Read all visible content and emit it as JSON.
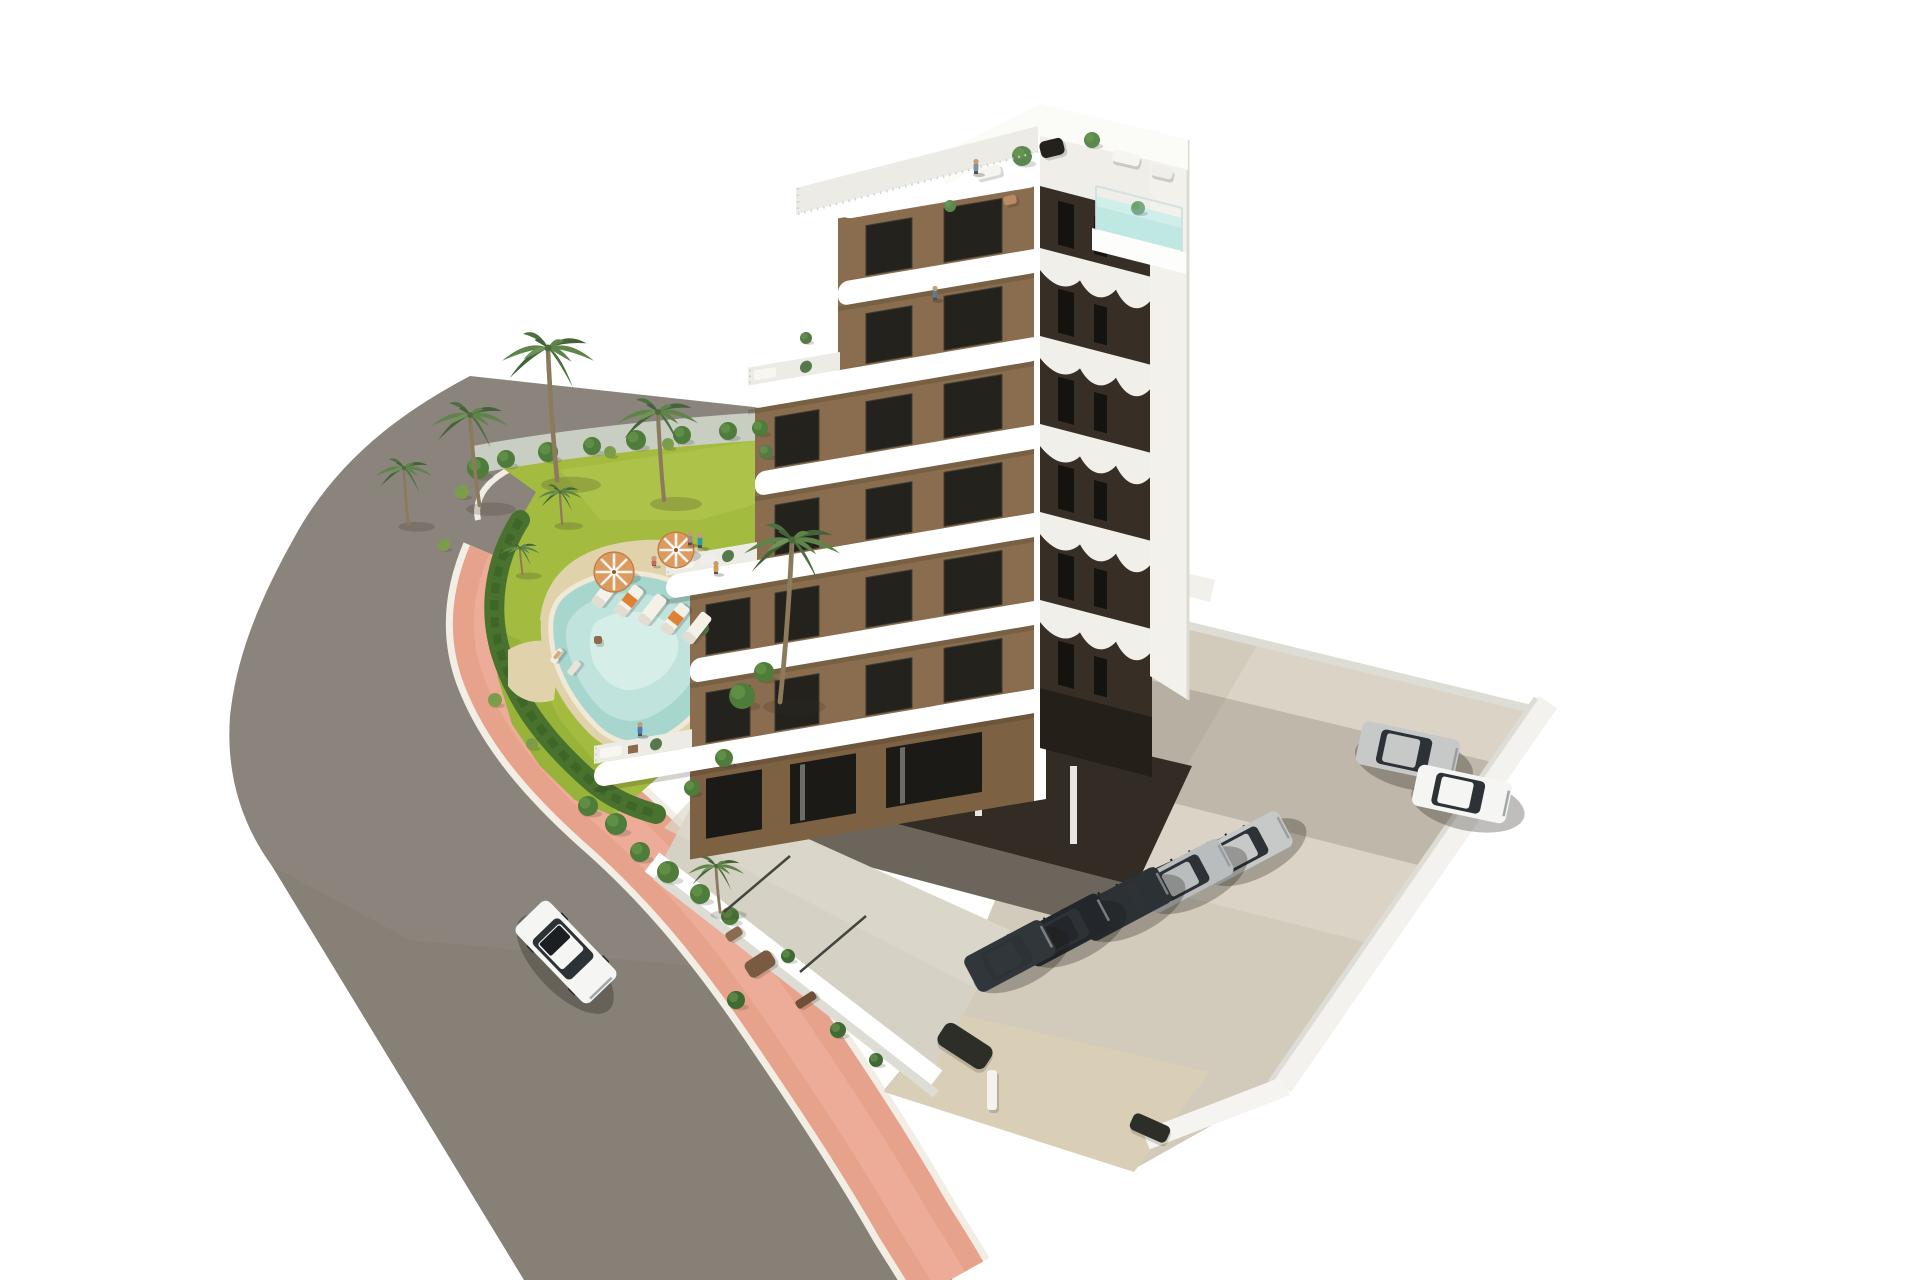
{
  "meta": {
    "type": "3d-architectural-render",
    "view": "aerial-isometric",
    "canvas": [
      1920,
      1280
    ]
  },
  "palette": {
    "road": "#8a847c",
    "road_dk": "#7d776f",
    "sidewalk": "#e7a28c",
    "sidewalk_hi": "#f0b5a0",
    "curb": "#f2eee5",
    "lawn": "#a3bc40",
    "lawn_hi": "#b5c851",
    "lawn_dk": "#8aa930",
    "gravel": "#c9cec3",
    "hedge": "#48722e",
    "hedge_dk": "#3a6126",
    "deck": "#e0d2ab",
    "coping": "#efe9d6",
    "water": "#a7d6cf",
    "water_hi": "#c4e6df",
    "water_pale": "#d9f0ea",
    "white": "#ffffff",
    "white_dim": "#ecebe5",
    "white_shade": "#dddcd5",
    "front_brown": "#8a6d4e",
    "side_dark": "#372f26",
    "side_dark2": "#241f18",
    "window": "#24221d",
    "door": "#1c1a16",
    "undercroft": "#322c24",
    "concrete": "#d2cabb",
    "concrete_hi": "#ded7c9",
    "terrace_floor": "#d6d1c5",
    "driveway": "#d8cfb6",
    "glass": "#c9d6d8",
    "car_white": "#f5f5f3",
    "car_silver": "#c7c9c8",
    "car_silver2": "#b9bdbe",
    "car_dark": "#2c3136",
    "car_dark2": "#23272c",
    "car_dark3": "#31363b",
    "trunk": "#8d7a5c",
    "frond_a": "#5f8449",
    "frond_b": "#4d7040",
    "frond_c": "#6f9455",
    "frond_d": "#436338",
    "umbrella": "#da9a60",
    "towel": "#e08034",
    "skin": "#c89b78"
  },
  "scene": {
    "stamps": {
      "bushes": [
        {
          "x": 478,
          "y": 468,
          "r": 11
        },
        {
          "x": 506,
          "y": 459,
          "r": 9
        },
        {
          "x": 548,
          "y": 452,
          "r": 10
        },
        {
          "x": 592,
          "y": 446,
          "r": 9
        },
        {
          "x": 636,
          "y": 440,
          "r": 10
        },
        {
          "x": 682,
          "y": 435,
          "r": 9
        },
        {
          "x": 728,
          "y": 431,
          "r": 9
        },
        {
          "x": 760,
          "y": 428,
          "r": 8
        },
        {
          "x": 462,
          "y": 492,
          "r": 7,
          "c": "#7f9c4a"
        },
        {
          "x": 444,
          "y": 545,
          "r": 6,
          "c": "#7f9c4a"
        },
        {
          "x": 495,
          "y": 700,
          "r": 7,
          "c": "#7f9c4a"
        },
        {
          "x": 532,
          "y": 744,
          "r": 6,
          "c": "#7f9c4a"
        },
        {
          "x": 610,
          "y": 452,
          "r": 6,
          "c": "#7f9c4a"
        },
        {
          "x": 668,
          "y": 444,
          "r": 6,
          "c": "#7f9c4a"
        },
        {
          "x": 742,
          "y": 696,
          "r": 13
        },
        {
          "x": 764,
          "y": 672,
          "r": 10
        },
        {
          "x": 724,
          "y": 758,
          "r": 9
        },
        {
          "x": 692,
          "y": 788,
          "r": 8
        },
        {
          "x": 588,
          "y": 806,
          "r": 10
        },
        {
          "x": 616,
          "y": 824,
          "r": 11
        },
        {
          "x": 640,
          "y": 852,
          "r": 10
        },
        {
          "x": 668,
          "y": 872,
          "r": 11
        },
        {
          "x": 700,
          "y": 894,
          "r": 10
        },
        {
          "x": 730,
          "y": 916,
          "r": 9
        },
        {
          "x": 736,
          "y": 1000,
          "r": 9,
          "c": "#3f6a33"
        },
        {
          "x": 788,
          "y": 956,
          "r": 7,
          "c": "#3f6a33"
        },
        {
          "x": 838,
          "y": 1030,
          "r": 8,
          "c": "#3f6a33"
        },
        {
          "x": 876,
          "y": 1060,
          "r": 7,
          "c": "#3f6a33"
        },
        {
          "x": 1022,
          "y": 156,
          "r": 10,
          "c": "#5c8750"
        },
        {
          "x": 1092,
          "y": 140,
          "r": 8,
          "c": "#5c8750"
        },
        {
          "x": 950,
          "y": 206,
          "r": 6,
          "c": "#5c8750"
        },
        {
          "x": 1138,
          "y": 208,
          "r": 7,
          "c": "#77a88a"
        },
        {
          "x": 766,
          "y": 452,
          "r": 7,
          "c": "#567a46"
        },
        {
          "x": 702,
          "y": 628,
          "r": 7,
          "c": "#567a46"
        },
        {
          "x": 806,
          "y": 338,
          "r": 6,
          "c": "#567a46"
        }
      ],
      "blobs": [
        {
          "x": 1052,
          "y": 148,
          "w": 24,
          "h": 17,
          "rot": -14,
          "c": "#24211d"
        },
        {
          "x": 988,
          "y": 172,
          "w": 26,
          "h": 11,
          "rot": -14,
          "c": "#f6f5f0"
        },
        {
          "x": 1010,
          "y": 200,
          "w": 13,
          "h": 9,
          "rot": -14,
          "c": "#b98a63"
        },
        {
          "x": 1126,
          "y": 158,
          "w": 28,
          "h": 12,
          "rot": 13,
          "c": "#f6f5f0"
        },
        {
          "x": 1162,
          "y": 172,
          "w": 22,
          "h": 11,
          "rot": 13,
          "c": "#efeeea"
        },
        {
          "x": 760,
          "y": 964,
          "w": 30,
          "h": 18,
          "rot": -33,
          "c": "#7a5a40"
        },
        {
          "x": 734,
          "y": 934,
          "w": 17,
          "h": 10,
          "rot": -33,
          "c": "#8a6b4e"
        },
        {
          "x": 806,
          "y": 1000,
          "w": 22,
          "h": 9,
          "rot": -33,
          "c": "#6e5038"
        },
        {
          "x": 557,
          "y": 656,
          "w": 16,
          "h": 7,
          "rot": -52,
          "c": "#f1eee6"
        },
        {
          "x": 574,
          "y": 668,
          "w": 16,
          "h": 7,
          "rot": -52,
          "c": "#e8e4da"
        },
        {
          "x": 557,
          "y": 655,
          "w": 9,
          "h": 3.5,
          "rot": -52,
          "c": "#d9a77c"
        },
        {
          "x": 598,
          "y": 640,
          "w": 8,
          "h": 8,
          "rot": 0,
          "c": "#8a6b4a"
        },
        {
          "x": 965,
          "y": 1046,
          "w": 56,
          "h": 26,
          "rot": 33,
          "c": "#2e2e29"
        },
        {
          "x": 992,
          "y": 1090,
          "w": 10,
          "h": 40,
          "rot": 0,
          "c": "#f3f2ee"
        },
        {
          "x": 1150,
          "y": 1128,
          "w": 40,
          "h": 18,
          "rot": 24,
          "c": "#2e2e29"
        }
      ],
      "loungers": [
        {
          "x": 606,
          "y": 592,
          "rot": -52
        },
        {
          "x": 629,
          "y": 601,
          "rot": -52,
          "towel": true
        },
        {
          "x": 652,
          "y": 610,
          "rot": -52
        },
        {
          "x": 675,
          "y": 619,
          "rot": -52,
          "towel": true
        },
        {
          "x": 697,
          "y": 628,
          "rot": -52
        }
      ],
      "umbrellas": [
        {
          "x": 614,
          "y": 572,
          "r": 20
        },
        {
          "x": 676,
          "y": 550,
          "r": 18
        }
      ],
      "fences": [
        {
          "x1": 798,
          "y1": 214,
          "x2": 1038,
          "y2": 152,
          "c": "#c9d6d8",
          "w": 2.5,
          "dash": "1.5 5"
        },
        {
          "x1": 798,
          "y1": 188,
          "x2": 798,
          "y2": 214,
          "c": "#c9d6d8",
          "w": 2.5,
          "dash": "1.5 5"
        },
        {
          "x1": 1008,
          "y1": 938,
          "x2": 1272,
          "y2": 816,
          "c": "#26261f",
          "w": 3
        },
        {
          "x1": 1008,
          "y1": 938,
          "x2": 1272,
          "y2": 816,
          "c": "#1b1b16",
          "w": 7,
          "dash": "2 18"
        },
        {
          "x1": 724,
          "y1": 912,
          "x2": 790,
          "y2": 856,
          "c": "#45453f",
          "w": 2.5
        },
        {
          "x1": 800,
          "y1": 972,
          "x2": 866,
          "y2": 916,
          "c": "#45453f",
          "w": 2.5
        }
      ],
      "palms": [
        {
          "x": 548,
          "y": 348,
          "s": 1.15,
          "t": [
            8,
            115
          ]
        },
        {
          "x": 470,
          "y": 415,
          "s": 0.95,
          "t": [
            10,
            95
          ]
        },
        {
          "x": 404,
          "y": 468,
          "s": 0.7,
          "t": [
            6,
            80
          ]
        },
        {
          "x": 658,
          "y": 412,
          "s": 1.0,
          "t": [
            6,
            88
          ]
        },
        {
          "x": 560,
          "y": 492,
          "s": 0.55,
          "t": [
            4,
            58
          ]
        },
        {
          "x": 520,
          "y": 548,
          "s": 0.5,
          "t": [
            5,
            52
          ]
        },
        {
          "x": 792,
          "y": 540,
          "s": 1.2,
          "t": [
            -10,
            135
          ]
        },
        {
          "x": 716,
          "y": 866,
          "s": 0.7,
          "t": [
            6,
            66
          ]
        }
      ],
      "cars": [
        {
          "x": 566,
          "y": 952,
          "rot": 46,
          "l": 106,
          "w": 46,
          "c": "car_white",
          "sun": true,
          "wh": true
        },
        {
          "x": 1408,
          "y": 752,
          "rot": 12,
          "l": 100,
          "w": 44,
          "c": "car_silver"
        },
        {
          "x": 1462,
          "y": 794,
          "rot": 12,
          "l": 96,
          "w": 42,
          "c": "car_white"
        },
        {
          "x": 1245,
          "y": 848,
          "rot": -28,
          "l": 92,
          "w": 40,
          "c": "car_silver"
        },
        {
          "x": 1186,
          "y": 876,
          "rot": -28,
          "l": 92,
          "w": 40,
          "c": "car_silver2"
        },
        {
          "x": 1124,
          "y": 904,
          "rot": -28,
          "l": 92,
          "w": 40,
          "c": "car_dark"
        },
        {
          "x": 1066,
          "y": 930,
          "rot": -28,
          "l": 90,
          "w": 40,
          "c": "car_dark2"
        },
        {
          "x": 1010,
          "y": 956,
          "rot": -28,
          "l": 88,
          "w": 40,
          "c": "car_dark3"
        }
      ],
      "people": [
        {
          "x": 976,
          "y": 174,
          "h": 15,
          "c": "#7e93a4"
        },
        {
          "x": 935,
          "y": 300,
          "h": 14,
          "c": "#5d7b94"
        },
        {
          "x": 700,
          "y": 548,
          "h": 15,
          "c": "#2f9aa4"
        },
        {
          "x": 640,
          "y": 736,
          "h": 14,
          "c": "#4a7fae"
        },
        {
          "x": 690,
          "y": 545,
          "h": 14,
          "c": "#9a8f80"
        },
        {
          "x": 654,
          "y": 566,
          "h": 10,
          "c": "#c96a50"
        },
        {
          "x": 716,
          "y": 574,
          "h": 13,
          "c": "#caa04e"
        }
      ]
    }
  }
}
